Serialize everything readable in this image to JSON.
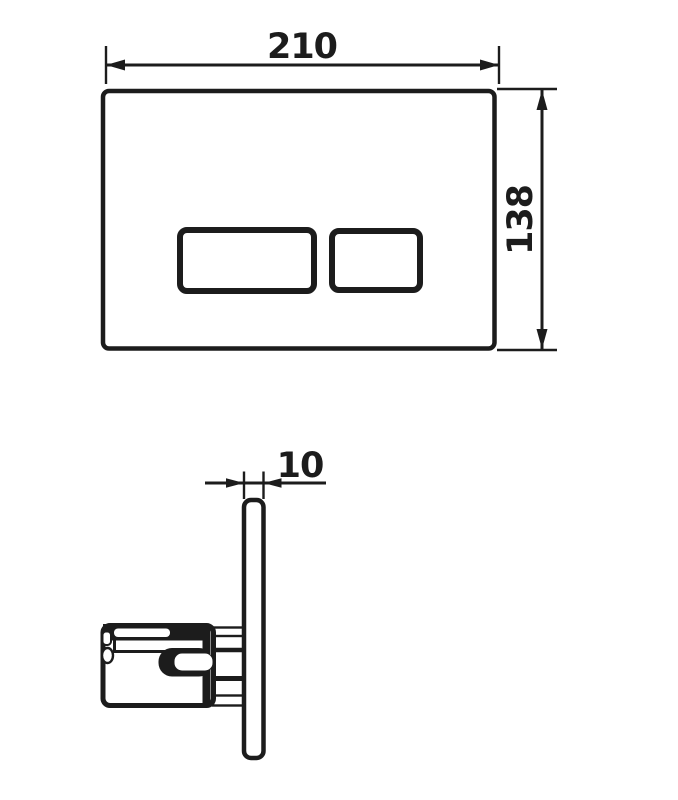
{
  "colors": {
    "line": "#1c1c1c",
    "background": "#ffffff"
  },
  "dimensions": {
    "plate_width": "210",
    "plate_height": "138",
    "plate_thickness": "10"
  }
}
